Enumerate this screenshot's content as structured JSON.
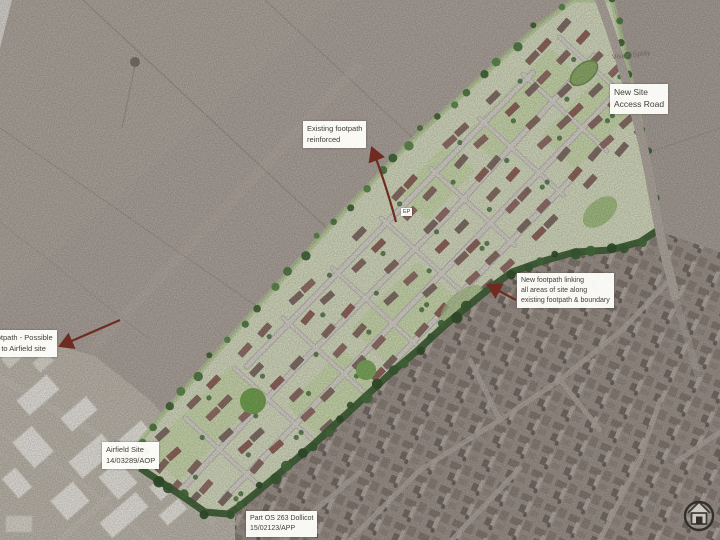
{
  "annotations": {
    "existing_footpath": {
      "lines": [
        "Existing footpath",
        "reinforced"
      ]
    },
    "vision_splay": {
      "text": "Vision Splay"
    },
    "new_site_access_road": {
      "lines": [
        "New Site",
        "Access Road"
      ]
    },
    "new_footpath": {
      "lines": [
        "New footpath linking",
        "all areas of site along",
        "existing footpath & boundary"
      ]
    },
    "airfield_link": {
      "lines": [
        "Footpath - Possible",
        "link to Airfield site"
      ]
    },
    "airfield_site": {
      "lines": [
        "Airfield Site",
        "14/03289/AOP"
      ]
    },
    "part_os": {
      "lines": [
        "Part OS 263 Dollicot",
        "15/02123/APP"
      ]
    },
    "ep_marker": {
      "text": "EP"
    }
  },
  "logo": {
    "icon": "house-in-circle"
  },
  "colors": {
    "aerial_field": "#b2a9a1",
    "site_green": "#dce3c6",
    "plot_green": "#c9dea6",
    "open_space_green": "#74a751",
    "tree_green": "#4e7a42",
    "hedge_green": "#3a5c32",
    "road_grey": "#dad7ce",
    "building_brown": "#8b6f66",
    "building_red": "#93655b",
    "arrow_red": "#6f2b22",
    "label_text": "#45403a",
    "village_grey": "#a1978f",
    "airfield_white": "#efede6"
  }
}
